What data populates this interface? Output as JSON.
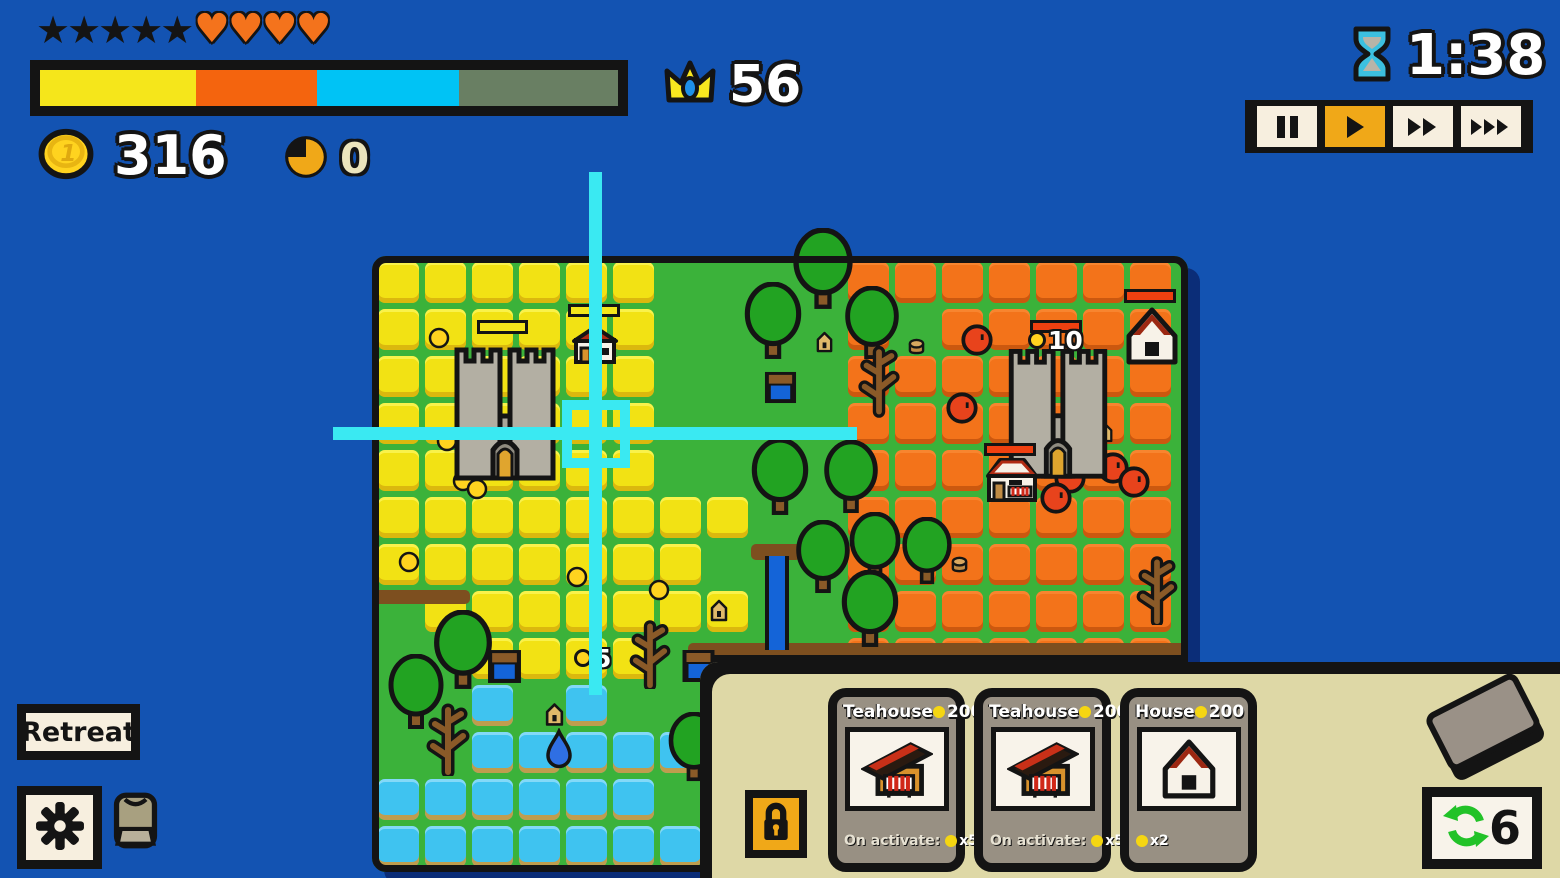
{
  "colors": {
    "background": "#1353b2",
    "map_green": "#3bb23a",
    "map_shadow": "#0b2d78",
    "panel_cream": "#ded8a6",
    "accent_amber": "#f0a818",
    "crosshair_cyan": "#3ae9f2",
    "enemy_red": "#e8431c",
    "ally_yellow": "#f2e214"
  },
  "hud": {
    "stars": "★★★★★",
    "hearts": "♥♥♥♥",
    "coins": "316",
    "pie_count": "0",
    "crowns": "56",
    "timer": "1:38",
    "progress_segments": [
      {
        "color": "#f5e61b",
        "pct": 27
      },
      {
        "color": "#f4640e",
        "pct": 21
      },
      {
        "color": "#00c3f5",
        "pct": 24.5
      },
      {
        "color": "#697f63",
        "pct": 27.5
      }
    ]
  },
  "playback": {
    "buttons": [
      "pause",
      "play",
      "fast-forward",
      "fastest-forward"
    ],
    "active_index": 1
  },
  "left_controls": {
    "retreat_label": "Retreat"
  },
  "cards": {
    "redraws": "6",
    "items": [
      {
        "title": "Teahouse",
        "cost": "200",
        "art": "teahouse",
        "footer_prefix": "On activate:",
        "footer_value": "x5"
      },
      {
        "title": "Teahouse",
        "cost": "200",
        "art": "teahouse",
        "footer_prefix": "On activate:",
        "footer_value": "x5"
      },
      {
        "title": "House",
        "cost": "200",
        "art": "house",
        "footer_prefix": "",
        "footer_value": "x2"
      }
    ]
  },
  "map": {
    "tile": 47,
    "rows": [
      "YYYYYYGGGGOOOOOOO",
      "YYYYYYGGGGOGOOOOO",
      "YYYYYYGGGGOOOOOOO",
      "YYYYYYGGGGOOOOOOO",
      "YYYYYYGGGGOOOOOOO",
      "YYYYYYYYGGOOOOOOO",
      "YYYYYYYGGGOOOOOOO",
      "GYYYYYYYGGOOOOOOO",
      "GGYYYYGGGGOOOOOOO",
      "GGWGWGGGGGGGGGGGG",
      "GGWWWWWGGGGGGGGGG",
      "WWWWWWGGGGGGGGGGG",
      "WWWWWWWGGGGGGGGGG"
    ],
    "features": [
      {
        "type": "dirt",
        "x": 374,
        "y": 590,
        "w": 96,
        "h": 14
      },
      {
        "type": "dirt",
        "x": 688,
        "y": 643,
        "w": 500,
        "h": 15
      },
      {
        "type": "cliff",
        "x": 688,
        "y": 655,
        "w": 500,
        "h": 22
      },
      {
        "type": "dirt",
        "x": 751,
        "y": 544,
        "w": 50,
        "h": 16
      },
      {
        "type": "river",
        "x": 765,
        "y": 556,
        "w": 24,
        "h": 94
      },
      {
        "type": "well",
        "x": 763,
        "y": 371,
        "w": 35,
        "h": 33
      },
      {
        "type": "well",
        "x": 487,
        "y": 649,
        "w": 35,
        "h": 35
      },
      {
        "type": "well",
        "x": 680,
        "y": 649,
        "w": 37,
        "h": 34
      },
      {
        "type": "stump",
        "x": 906,
        "y": 338,
        "w": 21,
        "h": 17
      },
      {
        "type": "stump",
        "x": 950,
        "y": 554,
        "w": 19,
        "h": 21
      },
      {
        "type": "tree",
        "x": 790,
        "y": 228,
        "w": 66,
        "h": 82
      },
      {
        "type": "tree",
        "x": 742,
        "y": 282,
        "w": 62,
        "h": 78
      },
      {
        "type": "tree",
        "x": 842,
        "y": 286,
        "w": 60,
        "h": 74
      },
      {
        "type": "tree",
        "x": 748,
        "y": 438,
        "w": 64,
        "h": 78
      },
      {
        "type": "tree",
        "x": 820,
        "y": 440,
        "w": 62,
        "h": 74
      },
      {
        "type": "tree",
        "x": 846,
        "y": 512,
        "w": 58,
        "h": 70
      },
      {
        "type": "tree",
        "x": 899,
        "y": 517,
        "w": 56,
        "h": 68
      },
      {
        "type": "tree",
        "x": 792,
        "y": 520,
        "w": 62,
        "h": 74
      },
      {
        "type": "tree",
        "x": 838,
        "y": 570,
        "w": 64,
        "h": 78
      },
      {
        "type": "tree",
        "x": 666,
        "y": 712,
        "w": 56,
        "h": 70
      },
      {
        "type": "tree",
        "x": 430,
        "y": 610,
        "w": 66,
        "h": 80
      },
      {
        "type": "tree",
        "x": 385,
        "y": 654,
        "w": 62,
        "h": 76
      },
      {
        "type": "bare",
        "x": 856,
        "y": 338,
        "w": 46,
        "h": 80
      },
      {
        "type": "bare",
        "x": 626,
        "y": 615,
        "w": 48,
        "h": 74
      },
      {
        "type": "bare",
        "x": 423,
        "y": 698,
        "w": 50,
        "h": 78
      },
      {
        "type": "bare",
        "x": 1133,
        "y": 551,
        "w": 48,
        "h": 74
      },
      {
        "type": "hut",
        "x": 815,
        "y": 330,
        "w": 19,
        "h": 24
      },
      {
        "type": "hut",
        "x": 1096,
        "y": 421,
        "w": 18,
        "h": 23
      },
      {
        "type": "hut",
        "x": 709,
        "y": 598,
        "w": 20,
        "h": 25
      },
      {
        "type": "hut",
        "x": 544,
        "y": 701,
        "w": 21,
        "h": 27
      },
      {
        "type": "droplet",
        "x": 545,
        "y": 728,
        "w": 28,
        "h": 41
      },
      {
        "type": "coin",
        "x": 428,
        "y": 327,
        "w": 22,
        "h": 22
      },
      {
        "type": "coin",
        "x": 436,
        "y": 430,
        "w": 22,
        "h": 22
      },
      {
        "type": "coin",
        "x": 452,
        "y": 470,
        "w": 22,
        "h": 22
      },
      {
        "type": "coin",
        "x": 466,
        "y": 478,
        "w": 22,
        "h": 22
      },
      {
        "type": "coin",
        "x": 398,
        "y": 551,
        "w": 22,
        "h": 22
      },
      {
        "type": "coin",
        "x": 566,
        "y": 566,
        "w": 22,
        "h": 22
      },
      {
        "type": "coin",
        "x": 648,
        "y": 579,
        "w": 22,
        "h": 22
      },
      {
        "type": "red",
        "x": 960,
        "y": 323,
        "w": 34,
        "h": 34
      },
      {
        "type": "red",
        "x": 945,
        "y": 391,
        "w": 34,
        "h": 34
      },
      {
        "type": "red",
        "x": 1053,
        "y": 461,
        "w": 34,
        "h": 34
      },
      {
        "type": "red",
        "x": 1039,
        "y": 481,
        "w": 34,
        "h": 34
      },
      {
        "type": "red",
        "x": 1096,
        "y": 451,
        "w": 34,
        "h": 34
      },
      {
        "type": "red",
        "x": 1117,
        "y": 465,
        "w": 34,
        "h": 34
      },
      {
        "type": "castle",
        "x": 452,
        "y": 330,
        "w": 106,
        "h": 154
      },
      {
        "type": "castle",
        "x": 1004,
        "y": 332,
        "w": 108,
        "h": 150
      },
      {
        "type": "cottage",
        "x": 571,
        "y": 324,
        "w": 48,
        "h": 40
      },
      {
        "type": "house",
        "x": 1125,
        "y": 306,
        "w": 54,
        "h": 60
      },
      {
        "type": "shop2",
        "x": 984,
        "y": 456,
        "w": 56,
        "h": 48
      },
      {
        "type": "bar",
        "x": 477,
        "y": 320,
        "w": 51,
        "h": 14,
        "color": "#f5e61b"
      },
      {
        "type": "bar",
        "x": 568,
        "y": 304,
        "w": 52,
        "h": 13,
        "color": "#f5e61b"
      },
      {
        "type": "bar",
        "x": 1030,
        "y": 320,
        "w": 52,
        "h": 13,
        "color": "#f04010"
      },
      {
        "type": "bar",
        "x": 1124,
        "y": 289,
        "w": 52,
        "h": 14,
        "color": "#f04010"
      },
      {
        "type": "bar",
        "x": 984,
        "y": 443,
        "w": 52,
        "h": 13,
        "color": "#f04010"
      },
      {
        "type": "coinlabel",
        "x": 1028,
        "y": 326,
        "w": 60,
        "h": 28,
        "text": "10"
      },
      {
        "type": "coinlabel",
        "x": 574,
        "y": 644,
        "w": 50,
        "h": 28,
        "text": "5"
      }
    ]
  }
}
